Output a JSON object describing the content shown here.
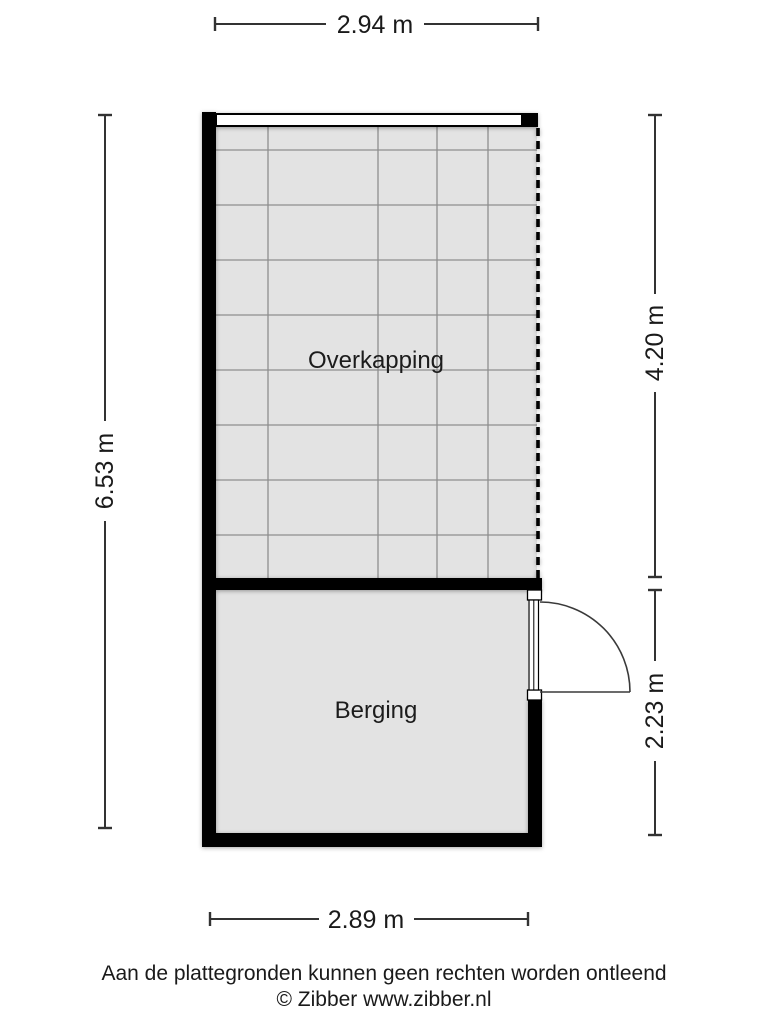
{
  "floorplan": {
    "rooms": {
      "overkapping": "Overkapping",
      "berging": "Berging"
    },
    "dimensions": {
      "top": "2.94 m",
      "left": "6.53 m",
      "right_top": "4.20 m",
      "right_bottom": "2.23 m",
      "bottom": "2.89 m"
    },
    "colors": {
      "wall": "#000000",
      "floor_fill": "#e3e3e3",
      "grid_line": "#8e8e8e",
      "dimension_line": "#333333",
      "text": "#1a1a1a"
    }
  },
  "footer": {
    "disclaimer": "Aan de plattegronden kunnen geen rechten worden ontleend",
    "copyright": "© Zibber www.zibber.nl"
  }
}
